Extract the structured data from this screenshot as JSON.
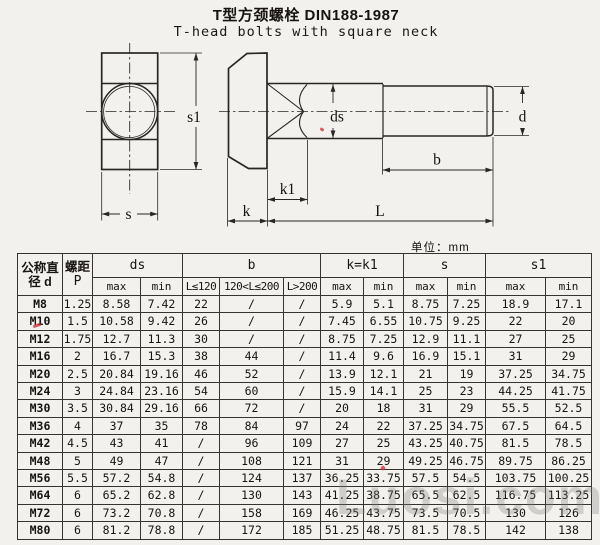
{
  "page": {
    "title_zh": "T型方颈螺栓 DIN188-1987",
    "title_en": "T-head bolts with square neck",
    "unit": "单位：mm",
    "watermark": "Luosi.com"
  },
  "diagram": {
    "labels": {
      "s1": "s1",
      "s": "s",
      "k": "k",
      "k1": "k1",
      "ds": "ds",
      "b": "b",
      "d": "d",
      "L": "L"
    }
  },
  "table": {
    "header": {
      "diameter_l1": "公称直",
      "diameter_l2": "径 d",
      "pitch_l1": "螺距",
      "pitch_l2": "P",
      "ds": "ds",
      "b": "b",
      "k": "k=k1",
      "s": "s",
      "s1": "s1",
      "max": "max",
      "min": "min",
      "b_ranges": [
        "L≤120",
        "120<L≤200",
        "L>200"
      ]
    },
    "rows": [
      [
        "M8",
        "1.25",
        "8.58",
        "7.42",
        "22",
        "/",
        "/",
        "5.9",
        "5.1",
        "8.75",
        "7.25",
        "18.9",
        "17.1"
      ],
      [
        "M10",
        "1.5",
        "10.58",
        "9.42",
        "26",
        "/",
        "/",
        "7.45",
        "6.55",
        "10.75",
        "9.25",
        "22",
        "20"
      ],
      [
        "M12",
        "1.75",
        "12.7",
        "11.3",
        "30",
        "/",
        "/",
        "8.75",
        "7.25",
        "12.9",
        "11.1",
        "27",
        "25"
      ],
      [
        "M16",
        "2",
        "16.7",
        "15.3",
        "38",
        "44",
        "/",
        "11.4",
        "9.6",
        "16.9",
        "15.1",
        "31",
        "29"
      ],
      [
        "M20",
        "2.5",
        "20.84",
        "19.16",
        "46",
        "52",
        "/",
        "13.9",
        "12.1",
        "21",
        "19",
        "37.25",
        "34.75"
      ],
      [
        "M24",
        "3",
        "24.84",
        "23.16",
        "54",
        "60",
        "/",
        "15.9",
        "14.1",
        "25",
        "23",
        "44.25",
        "41.75"
      ],
      [
        "M30",
        "3.5",
        "30.84",
        "29.16",
        "66",
        "72",
        "/",
        "20",
        "18",
        "31",
        "29",
        "55.5",
        "52.5"
      ],
      [
        "M36",
        "4",
        "37",
        "35",
        "78",
        "84",
        "97",
        "24",
        "22",
        "37.25",
        "34.75",
        "67.5",
        "64.5"
      ],
      [
        "M42",
        "4.5",
        "43",
        "41",
        "/",
        "96",
        "109",
        "27",
        "25",
        "43.25",
        "40.75",
        "81.5",
        "78.5"
      ],
      [
        "M48",
        "5",
        "49",
        "47",
        "/",
        "108",
        "121",
        "31",
        "29",
        "49.25",
        "46.75",
        "89.75",
        "86.25"
      ],
      [
        "M56",
        "5.5",
        "57.2",
        "54.8",
        "/",
        "124",
        "137",
        "36.25",
        "33.75",
        "57.5",
        "54.5",
        "103.75",
        "100.25"
      ],
      [
        "M64",
        "6",
        "65.2",
        "62.8",
        "/",
        "130",
        "143",
        "41.25",
        "38.75",
        "65.5",
        "62.5",
        "116.75",
        "113.25"
      ],
      [
        "M72",
        "6",
        "73.2",
        "70.8",
        "/",
        "158",
        "169",
        "46.25",
        "43.75",
        "73.5",
        "70.5",
        "130",
        "126"
      ],
      [
        "M80",
        "6",
        "81.2",
        "78.8",
        "/",
        "172",
        "185",
        "51.25",
        "48.75",
        "81.5",
        "78.5",
        "142",
        "138"
      ]
    ]
  }
}
